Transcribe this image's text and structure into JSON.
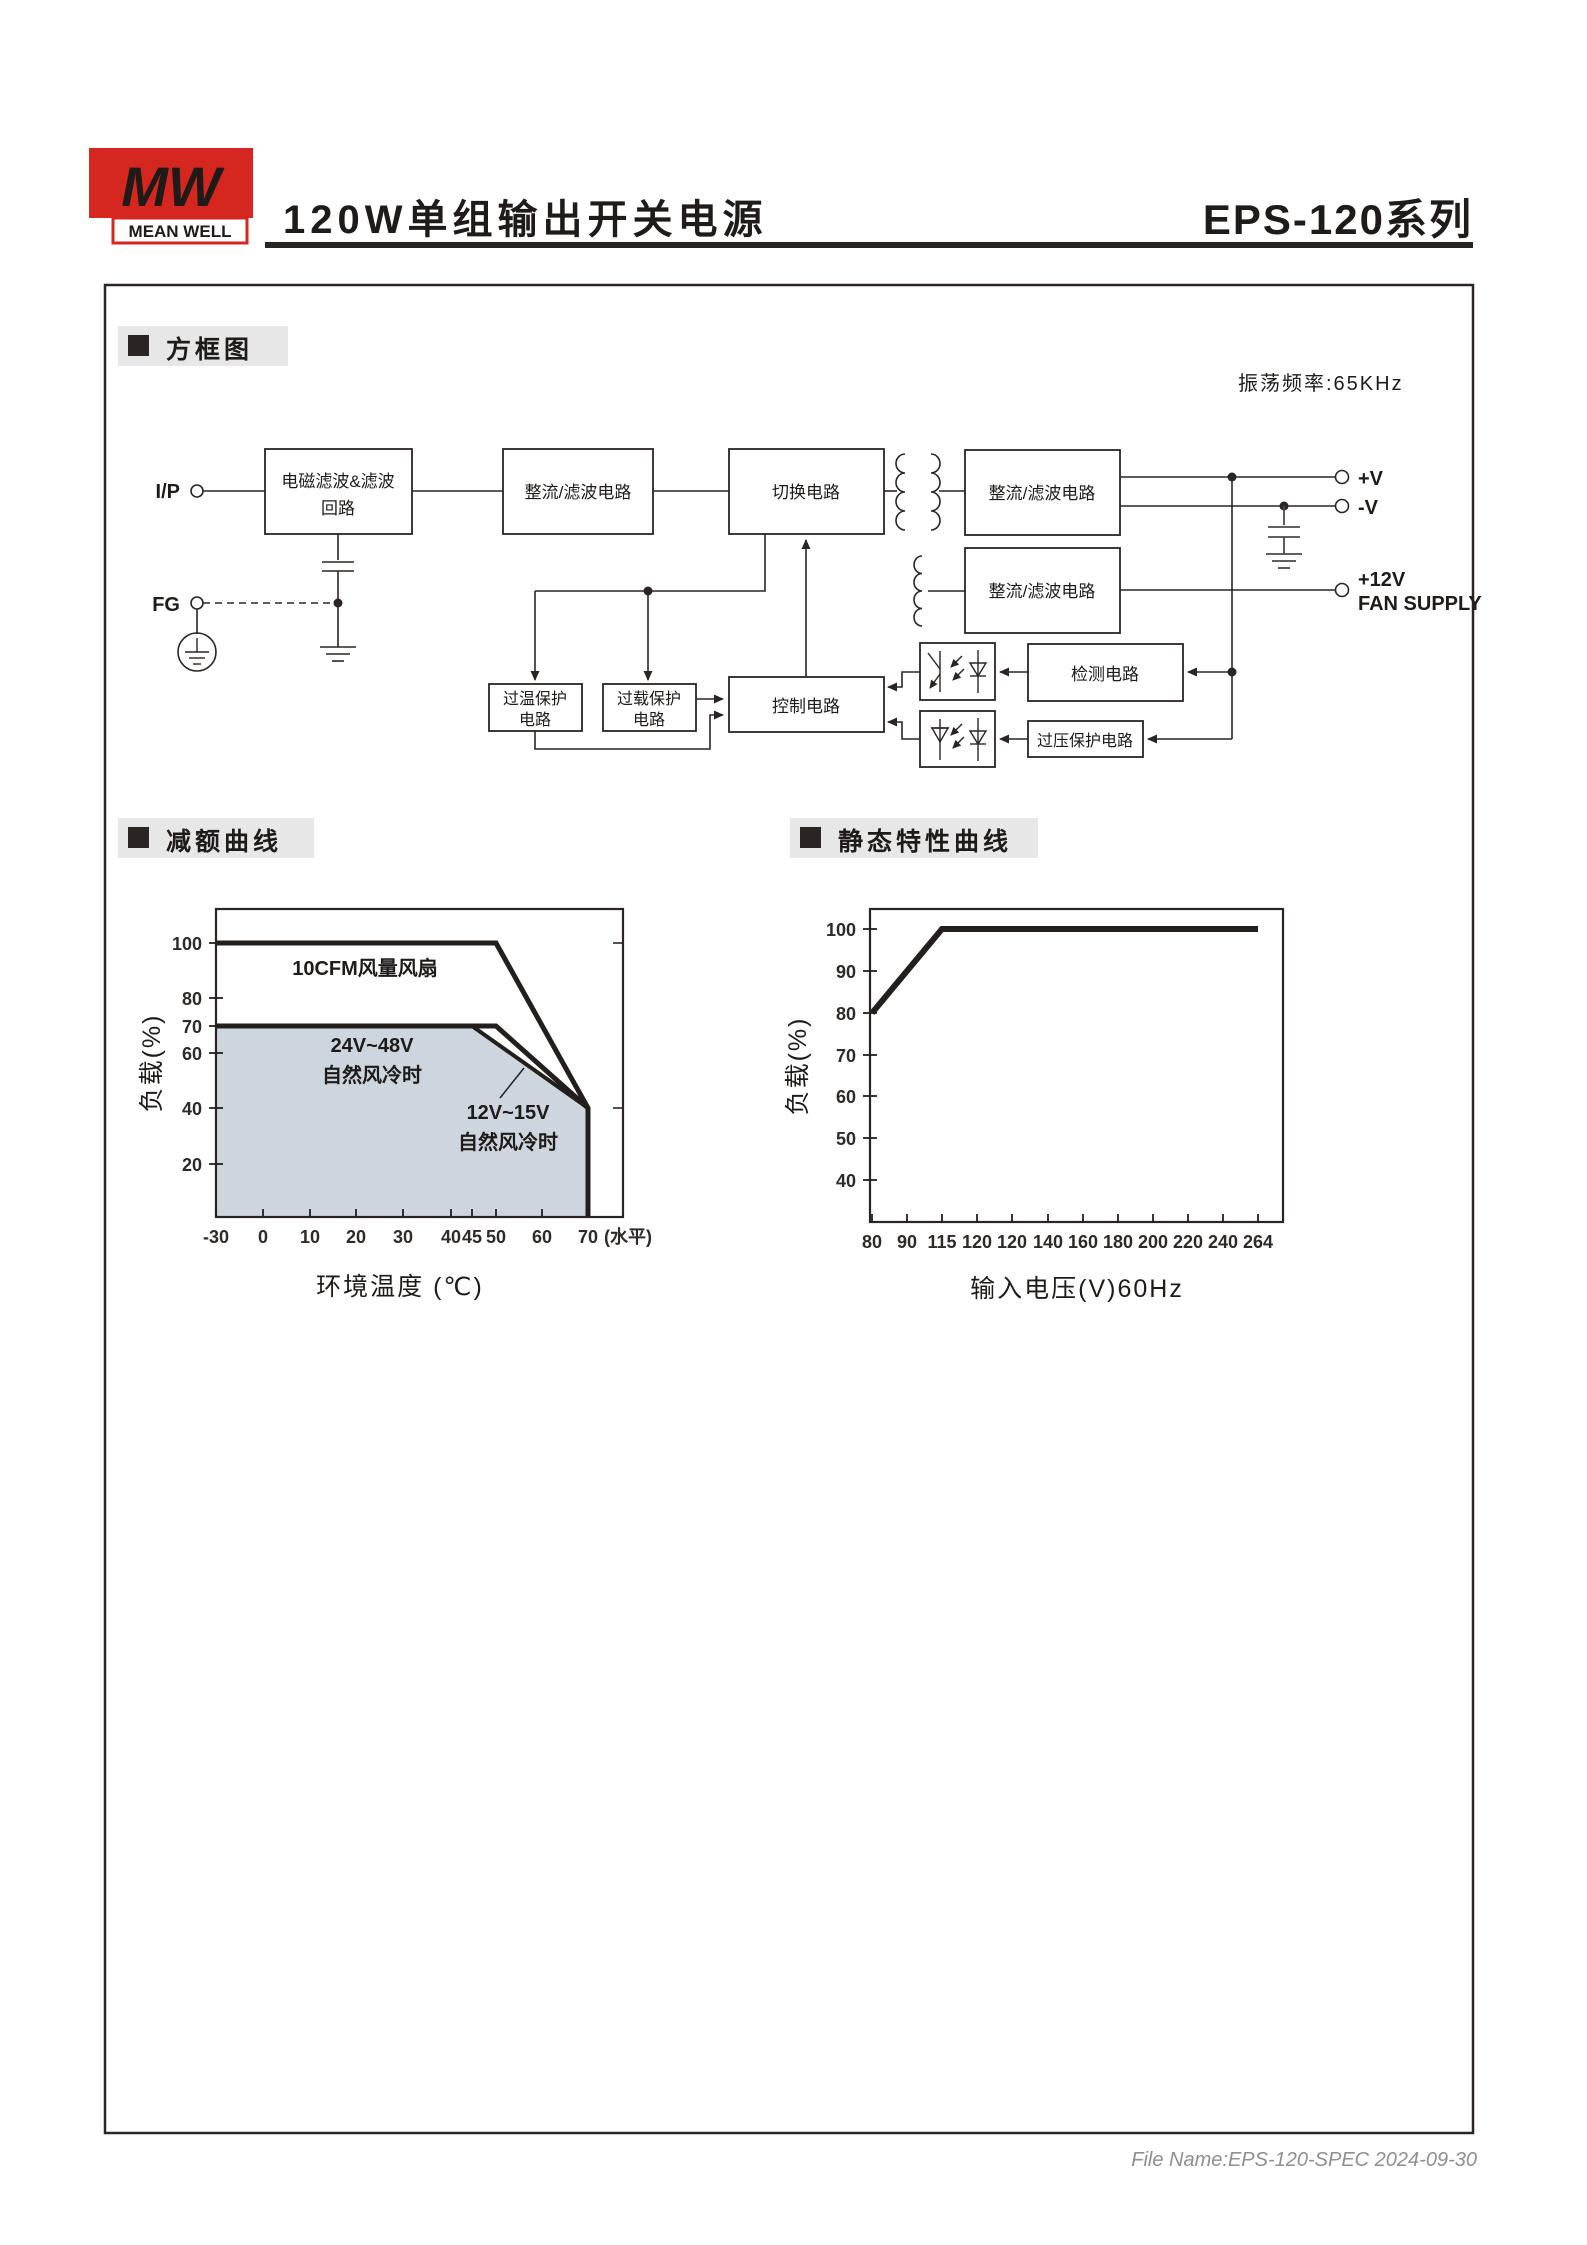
{
  "header": {
    "logo": {
      "monogram": "MW",
      "brand": "MEAN WELL"
    },
    "title": "120W单组输出开关电源",
    "series": "EPS-120系列",
    "brand_color": "#d5271f"
  },
  "sections": {
    "block_diagram": "方框图",
    "derating_curve": "减额曲线",
    "static_curve": "静态特性曲线"
  },
  "block_diagram": {
    "osc_freq": "振荡频率:65KHz",
    "terminals": {
      "input": "I/P",
      "fg": "FG",
      "v_pos": "+V",
      "v_neg": "-V",
      "v_aux": "+12V",
      "fan": "FAN SUPPLY"
    },
    "blocks": {
      "emi_line1": "电磁滤波&滤波",
      "emi_line2": "回路",
      "rectifier_input": "整流/滤波电路",
      "switching": "切换电路",
      "rectifier_main": "整流/滤波电路",
      "rectifier_aux": "整流/滤波电路",
      "otp_line1": "过温保护",
      "otp_line2": "电路",
      "olp_line1": "过载保护",
      "olp_line2": "电路",
      "control": "控制电路",
      "detection": "检测电路",
      "ovp": "过压保护电路"
    }
  },
  "charts": {
    "derating": {
      "ylabel": "负载(%)",
      "xlabel": "环境温度 (℃)",
      "x_suffix": "(水平)",
      "annotations": {
        "fan": "10CFM风量风扇",
        "v24_48": "24V~48V",
        "v24_48_sub": "自然风冷时",
        "v12_15": "12V~15V",
        "v12_15_sub": "自然风冷时"
      },
      "area_color": "#cdd5df"
    },
    "static": {
      "ylabel": "负载(%)",
      "xlabel": "输入电压(V)60Hz"
    }
  },
  "chart_data": [
    {
      "type": "line",
      "title": "减额曲线",
      "xlabel": "环境温度 (℃)",
      "ylabel": "负载(%)",
      "x_note": "(水平)",
      "x_tick_labels": [
        "-30",
        "0",
        "10",
        "20",
        "30",
        "40",
        "45",
        "50",
        "60",
        "70"
      ],
      "y_tick_labels": [
        "100",
        "80",
        "70",
        "60",
        "40",
        "20"
      ],
      "ylim": [
        0,
        110
      ],
      "grid": false,
      "series": [
        {
          "name": "10CFM风量风扇",
          "points": [
            [
              -30,
              100
            ],
            [
              50,
              100
            ],
            [
              70,
              40
            ],
            [
              70,
              0
            ]
          ]
        },
        {
          "name": "24V~48V 自然风冷时",
          "points": [
            [
              -30,
              70
            ],
            [
              50,
              70
            ],
            [
              70,
              40
            ]
          ]
        },
        {
          "name": "12V~15V 自然风冷时",
          "points": [
            [
              -30,
              70
            ],
            [
              45,
              70
            ],
            [
              70,
              40
            ]
          ],
          "area": true
        }
      ]
    },
    {
      "type": "line",
      "title": "静态特性曲线",
      "xlabel": "输入电压(V)60Hz",
      "ylabel": "负载(%)",
      "x_tick_labels": [
        "80",
        "90",
        "115",
        "120",
        "120",
        "140",
        "160",
        "180",
        "200",
        "220",
        "240",
        "264"
      ],
      "y_tick_labels": [
        "100",
        "90",
        "80",
        "70",
        "60",
        "50",
        "40"
      ],
      "ylim": [
        30,
        105
      ],
      "grid": false,
      "series": [
        {
          "name": "负载",
          "points": [
            [
              80,
              80
            ],
            [
              115,
              100
            ],
            [
              264,
              100
            ]
          ]
        }
      ]
    }
  ],
  "footer": {
    "file_name": "File Name:EPS-120-SPEC  2024-09-30"
  }
}
